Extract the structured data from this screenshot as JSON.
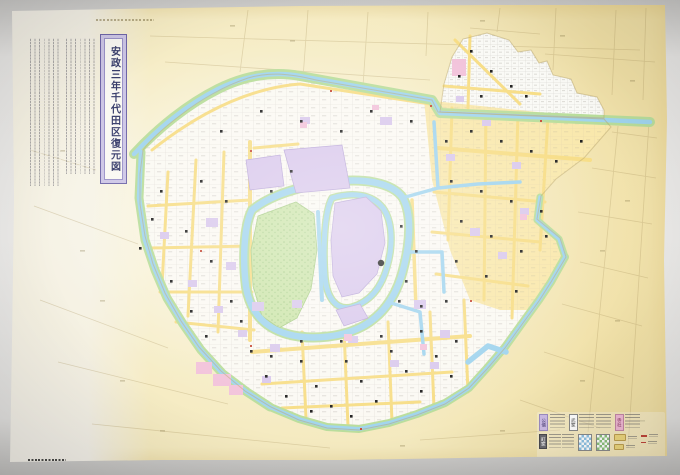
{
  "map": {
    "title": "安政三年千代田区復元図",
    "title_color": "#383d6b",
    "title_border_color": "#6f66a8"
  },
  "legend": {
    "categories": [
      {
        "label": "公儀",
        "color": "#cdbce6",
        "meaning": "goverment-land-swatch"
      },
      {
        "label": "武家",
        "color": "#ffffff",
        "meaning": "samurai-land-swatch"
      },
      {
        "label": "寺社",
        "color": "#f0b9d4",
        "meaning": "temple-shrine-swatch"
      },
      {
        "label": "町家",
        "color": "#6b6b70",
        "meaning": "townsfolk-land-swatch"
      },
      {
        "label": "濠川",
        "color": "#8fc3e4",
        "meaning": "moat-river-swatch"
      },
      {
        "label": "緑地",
        "color": "#8cc27c",
        "meaning": "green-bank-swatch"
      },
      {
        "label": "道路",
        "color": "#edd77e",
        "meaning": "road-swatch"
      },
      {
        "label": "橋門",
        "color": "#c0463a",
        "meaning": "bridge-gate-mark"
      }
    ]
  },
  "colors": {
    "paper_aged": "#f4e9bd",
    "paper_margin": "#f2efe7",
    "ward_base": "#fbf9f3",
    "water": "#a0d4ee",
    "bank_green": "#b9dd9b",
    "garden_green": "#cde5ab",
    "castle_purple": "#d9c8ec",
    "temple_pink": "#f2c2da",
    "street_yellow": "#f7dd85",
    "marker_black": "#1d1d1d",
    "mark_red": "#c64a38"
  }
}
